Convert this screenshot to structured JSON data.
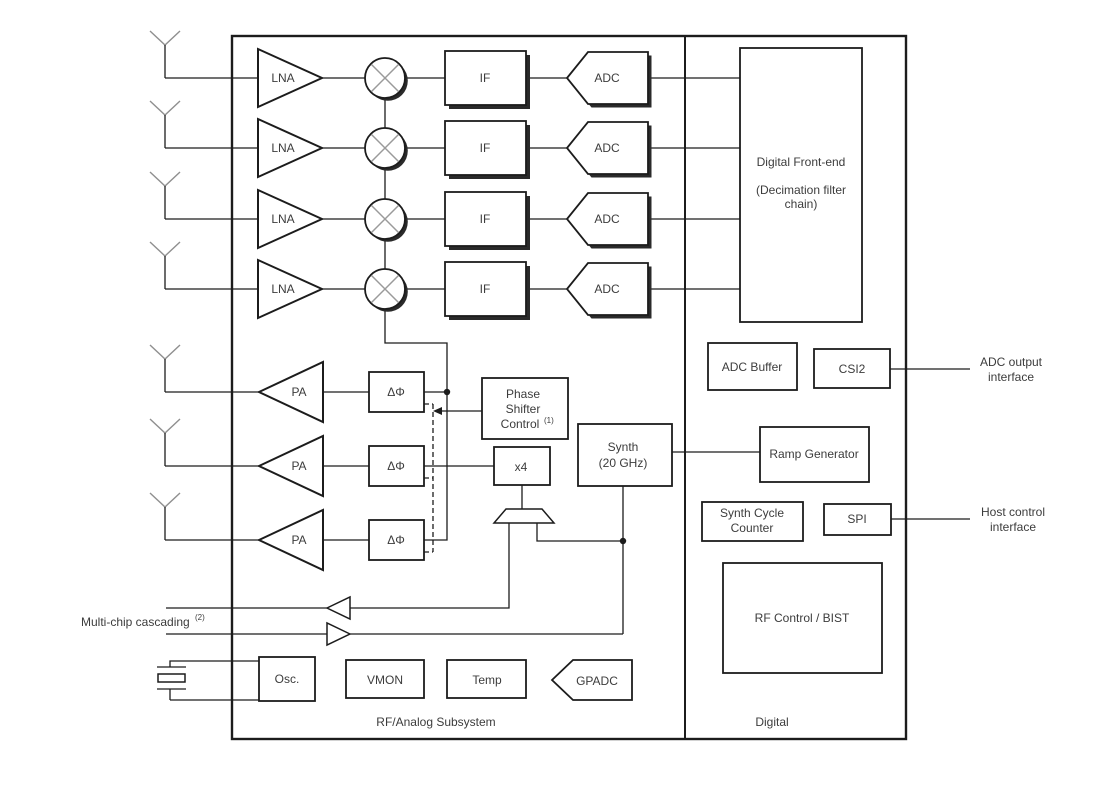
{
  "colors": {
    "line": "#1c1c1c",
    "text": "#3c3c3c",
    "muted_gray": "#8f8f8f",
    "background": "#ffffff"
  },
  "rf_panel": {
    "caption": "RF/Analog Subsystem",
    "lna": "LNA",
    "if": "IF",
    "adc": "ADC",
    "pa": "PA",
    "phase_shifter": "ΔΦ",
    "phase_shifter_control": {
      "lines": [
        "Phase",
        "Shifter",
        "Control"
      ],
      "note": "(1)"
    },
    "multiplier": "x4",
    "synth": {
      "lines": [
        "Synth",
        "(20 GHz)"
      ]
    },
    "osc": "Osc.",
    "vmon": "VMON",
    "temp": "Temp",
    "gpadc": "GPADC"
  },
  "digital_panel": {
    "caption": "Digital",
    "dfe": {
      "lines": [
        "Digital Front-end",
        "(Decimation filter",
        "chain)"
      ]
    },
    "adc_buffer": "ADC Buffer",
    "csi2": "CSI2",
    "ramp_generator": "Ramp Generator",
    "synth_cycle_counter": {
      "lines": [
        "Synth Cycle",
        "Counter"
      ]
    },
    "spi": "SPI",
    "rf_control_bist": "RF Control / BIST"
  },
  "external": {
    "adc_output_interface": {
      "lines": [
        "ADC output",
        "interface"
      ]
    },
    "host_control_interface": {
      "lines": [
        "Host control",
        "interface"
      ]
    },
    "multichip_cascading": {
      "text": "Multi-chip cascading",
      "note": "(2)"
    }
  }
}
